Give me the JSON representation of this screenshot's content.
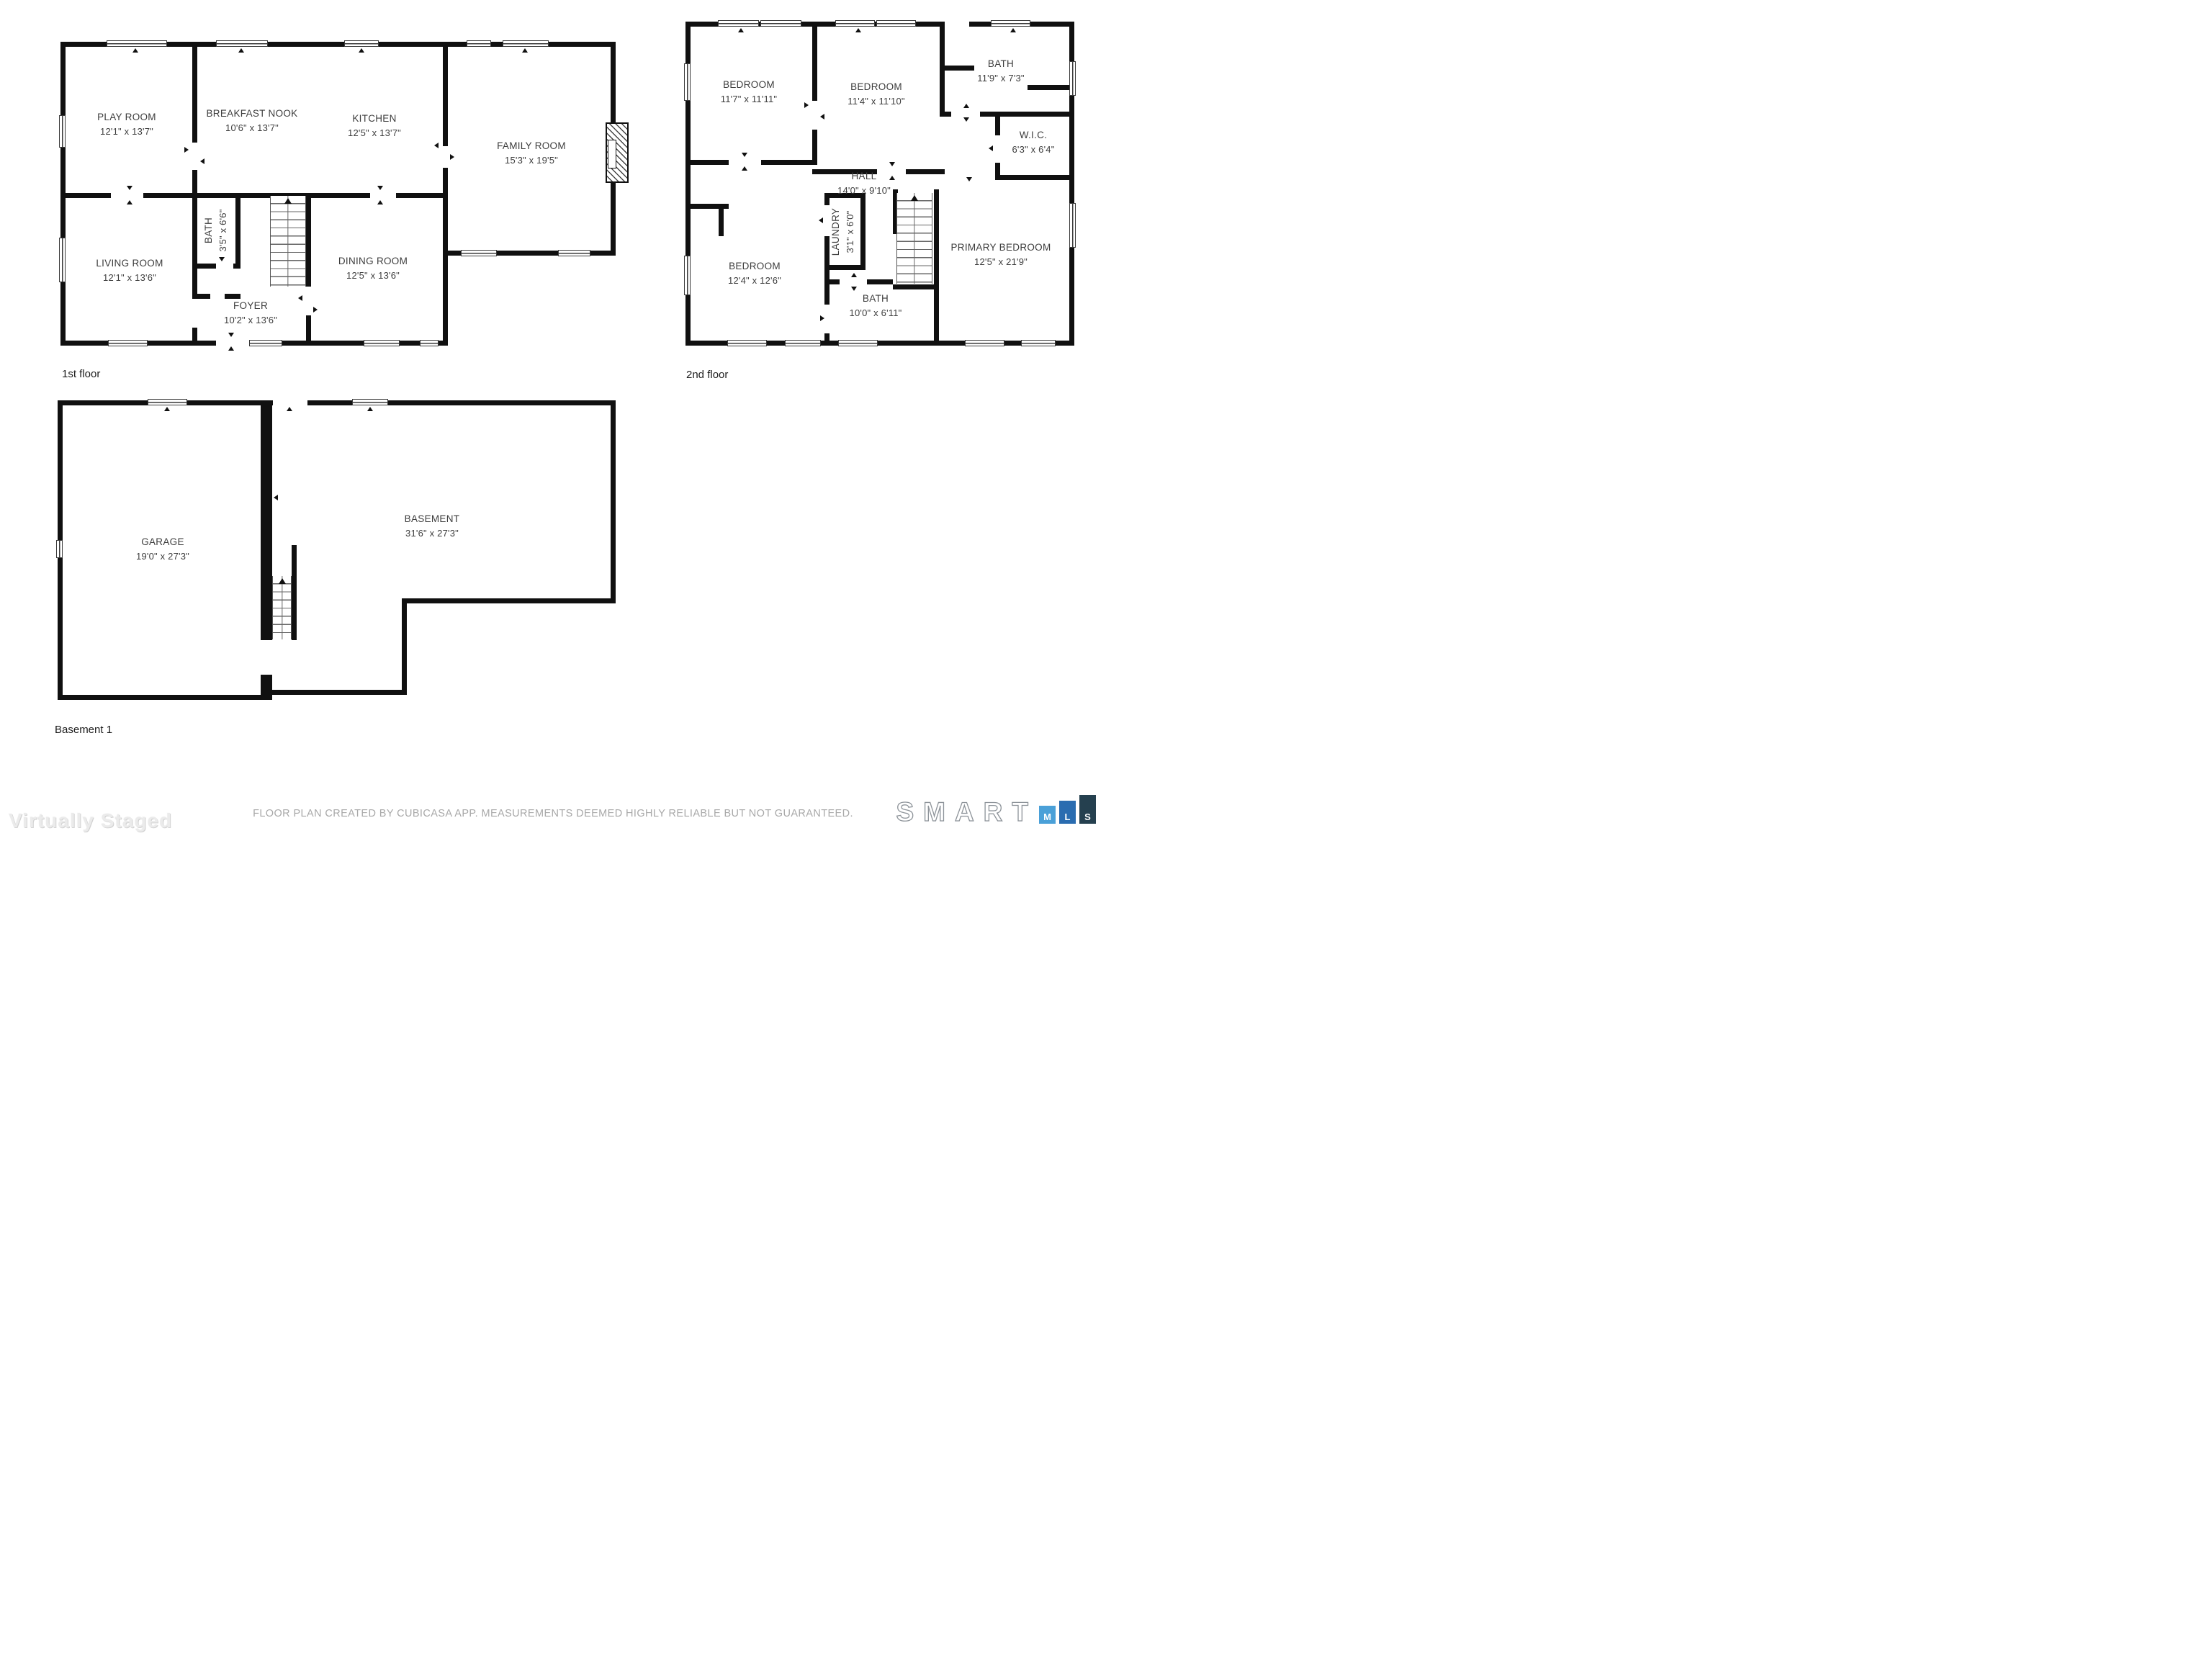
{
  "floors": {
    "first": {
      "label": "1st floor",
      "rooms": [
        {
          "name": "PLAY ROOM",
          "dims": "12'1\" x 13'7\""
        },
        {
          "name": "BREAKFAST NOOK",
          "dims": "10'6\" x 13'7\""
        },
        {
          "name": "KITCHEN",
          "dims": "12'5\" x 13'7\""
        },
        {
          "name": "FAMILY ROOM",
          "dims": "15'3\" x 19'5\""
        },
        {
          "name": "LIVING ROOM",
          "dims": "12'1\" x 13'6\""
        },
        {
          "name": "BATH",
          "dims": "3'5\" x 6'6\""
        },
        {
          "name": "DINING ROOM",
          "dims": "12'5\" x 13'6\""
        },
        {
          "name": "FOYER",
          "dims": "10'2\" x 13'6\""
        }
      ]
    },
    "second": {
      "label": "2nd floor",
      "rooms": [
        {
          "name": "BEDROOM",
          "dims": "11'7\" x 11'11\""
        },
        {
          "name": "BEDROOM",
          "dims": "11'4\" x 11'10\""
        },
        {
          "name": "BATH",
          "dims": "11'9\" x 7'3\""
        },
        {
          "name": "W.I.C.",
          "dims": "6'3\" x 6'4\""
        },
        {
          "name": "HALL",
          "dims": "14'0\" x 9'10\""
        },
        {
          "name": "LAUNDRY",
          "dims": "3'1\" x 6'0\""
        },
        {
          "name": "BEDROOM",
          "dims": "12'4\" x 12'6\""
        },
        {
          "name": "PRIMARY BEDROOM",
          "dims": "12'5\" x 21'9\""
        },
        {
          "name": "BATH",
          "dims": "10'0\" x 6'11\""
        }
      ]
    },
    "basement": {
      "label": "Basement 1",
      "rooms": [
        {
          "name": "GARAGE",
          "dims": "19'0\" x 27'3\""
        },
        {
          "name": "BASEMENT",
          "dims": "31'6\" x 27'3\""
        }
      ]
    }
  },
  "footer": {
    "disclaimer": "FLOOR PLAN CREATED BY CUBICASA APP. MEASUREMENTS DEEMED HIGHLY RELIABLE BUT NOT GUARANTEED.",
    "watermark": "Virtually Staged",
    "logo": {
      "word": "SMART",
      "blocks": [
        {
          "letter": "M",
          "color": "#4aa0d8",
          "height": 25
        },
        {
          "letter": "L",
          "color": "#2a6cb0",
          "height": 32
        },
        {
          "letter": "S",
          "color": "#25404f",
          "height": 40
        }
      ]
    }
  },
  "colors": {
    "wall": "#101010",
    "room_text": "#3d3d3d",
    "disclaimer_text": "#a8a8a8",
    "watermark_text": "#ebebeb"
  }
}
